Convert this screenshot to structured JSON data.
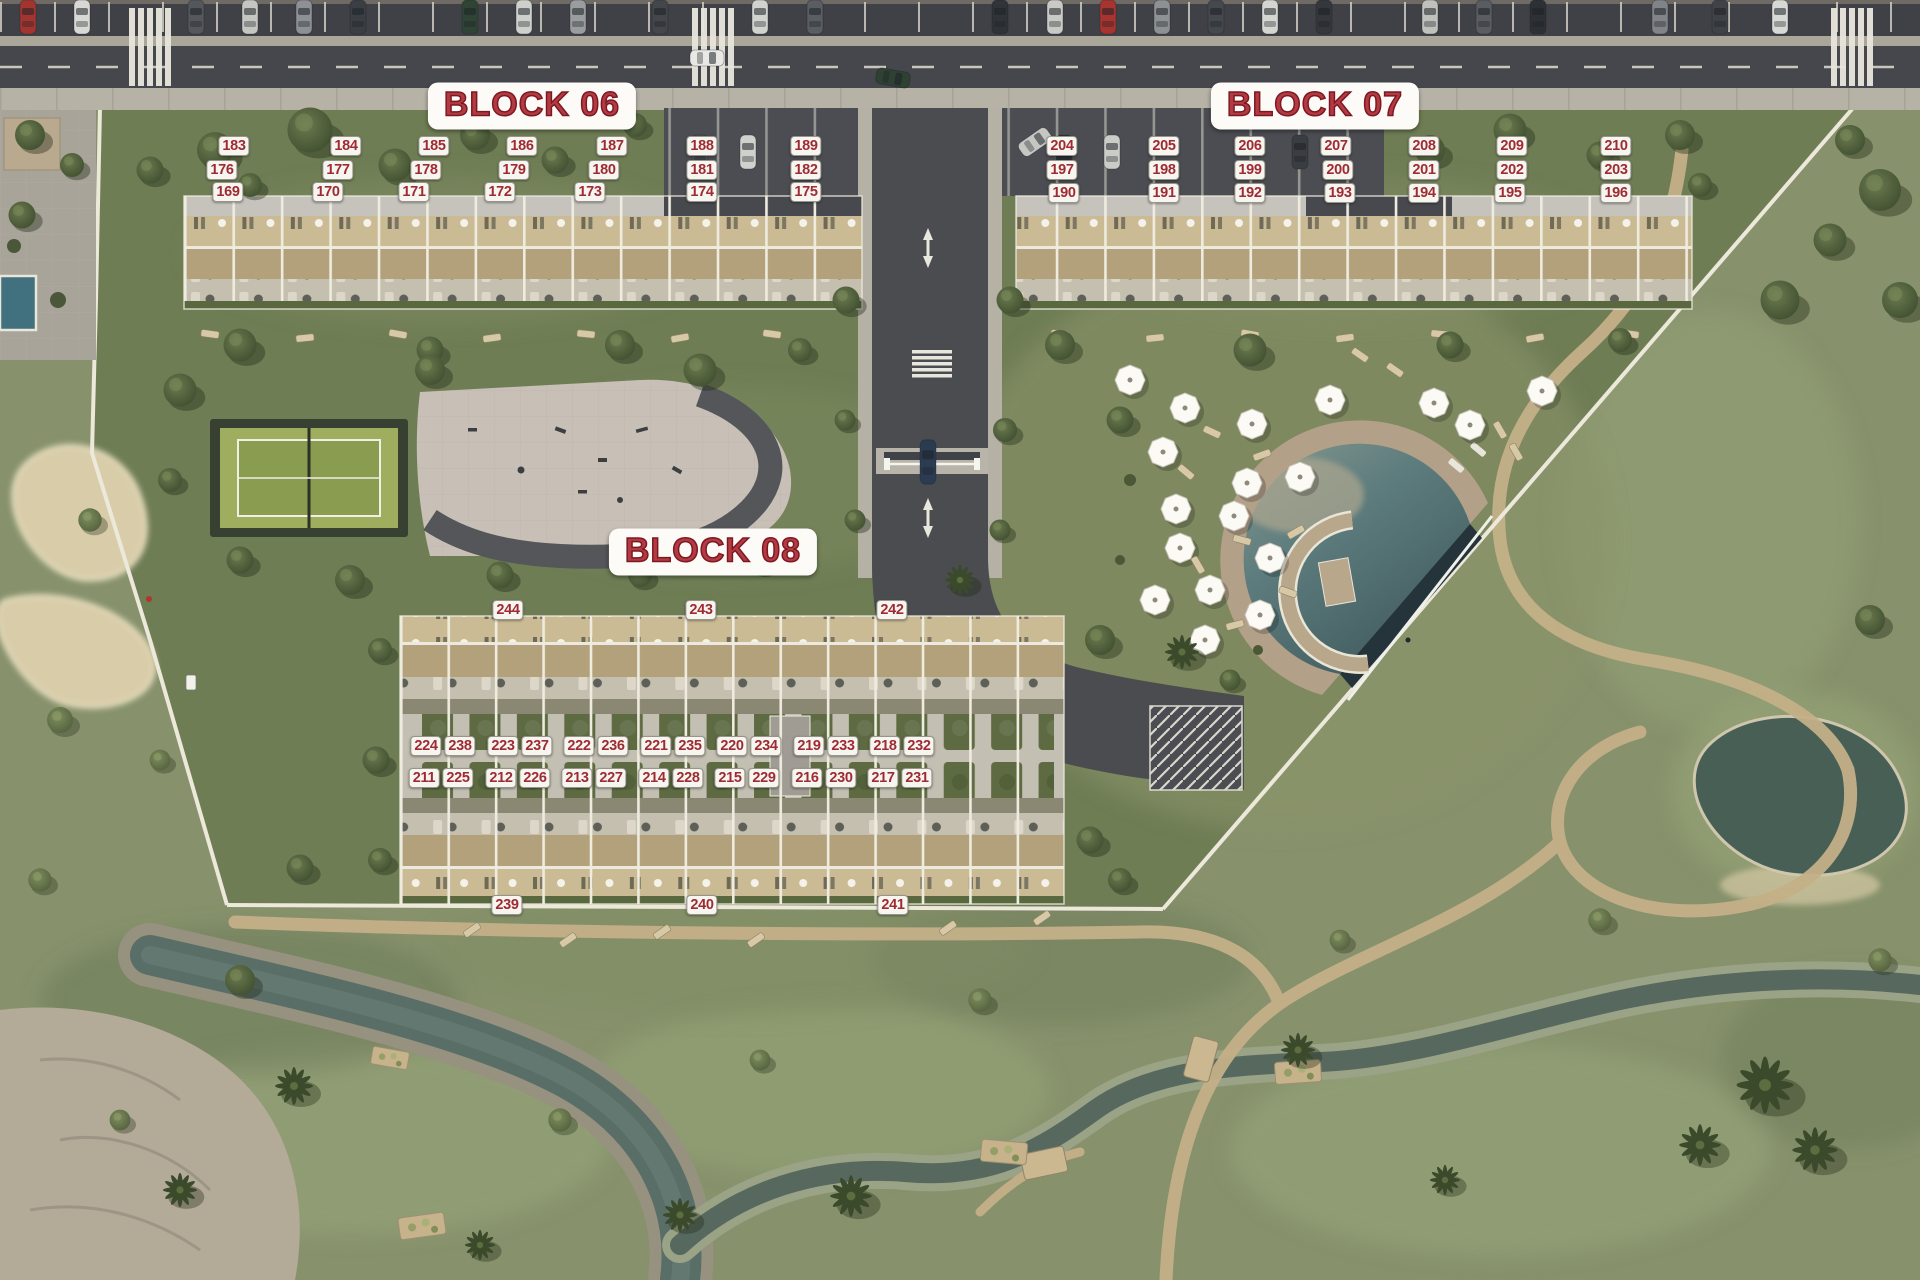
{
  "map": {
    "type": "residential-masterplan-aerial",
    "accent_red": "#9e2b33",
    "chip_bg": "#f7f5ef",
    "features": [
      "main-road",
      "entrance-road",
      "padel-court",
      "playground",
      "swimming-pool",
      "umbrella-lawn",
      "golf-course",
      "sand-bunkers",
      "pond",
      "stream"
    ]
  },
  "blocks": [
    {
      "id": "block-06",
      "title": "BLOCK 06",
      "units": [
        {
          "n": "183",
          "x": 234,
          "y": 146
        },
        {
          "n": "184",
          "x": 346,
          "y": 146
        },
        {
          "n": "185",
          "x": 434,
          "y": 146
        },
        {
          "n": "186",
          "x": 522,
          "y": 146
        },
        {
          "n": "187",
          "x": 612,
          "y": 146
        },
        {
          "n": "188",
          "x": 702,
          "y": 146
        },
        {
          "n": "189",
          "x": 806,
          "y": 146
        },
        {
          "n": "176",
          "x": 222,
          "y": 170
        },
        {
          "n": "177",
          "x": 338,
          "y": 170
        },
        {
          "n": "178",
          "x": 426,
          "y": 170
        },
        {
          "n": "179",
          "x": 514,
          "y": 170
        },
        {
          "n": "180",
          "x": 604,
          "y": 170
        },
        {
          "n": "181",
          "x": 702,
          "y": 170
        },
        {
          "n": "182",
          "x": 806,
          "y": 170
        },
        {
          "n": "169",
          "x": 228,
          "y": 192
        },
        {
          "n": "170",
          "x": 328,
          "y": 192
        },
        {
          "n": "171",
          "x": 414,
          "y": 192
        },
        {
          "n": "172",
          "x": 500,
          "y": 192
        },
        {
          "n": "173",
          "x": 590,
          "y": 192
        },
        {
          "n": "174",
          "x": 702,
          "y": 192
        },
        {
          "n": "175",
          "x": 806,
          "y": 192
        }
      ]
    },
    {
      "id": "block-07",
      "title": "BLOCK 07",
      "units": [
        {
          "n": "204",
          "x": 1062,
          "y": 146
        },
        {
          "n": "205",
          "x": 1164,
          "y": 146
        },
        {
          "n": "206",
          "x": 1250,
          "y": 146
        },
        {
          "n": "207",
          "x": 1336,
          "y": 146
        },
        {
          "n": "208",
          "x": 1424,
          "y": 146
        },
        {
          "n": "209",
          "x": 1512,
          "y": 146
        },
        {
          "n": "210",
          "x": 1616,
          "y": 146
        },
        {
          "n": "197",
          "x": 1062,
          "y": 170
        },
        {
          "n": "198",
          "x": 1164,
          "y": 170
        },
        {
          "n": "199",
          "x": 1250,
          "y": 170
        },
        {
          "n": "200",
          "x": 1338,
          "y": 170
        },
        {
          "n": "201",
          "x": 1424,
          "y": 170
        },
        {
          "n": "202",
          "x": 1512,
          "y": 170
        },
        {
          "n": "203",
          "x": 1616,
          "y": 170
        },
        {
          "n": "190",
          "x": 1064,
          "y": 193
        },
        {
          "n": "191",
          "x": 1164,
          "y": 193
        },
        {
          "n": "192",
          "x": 1250,
          "y": 193
        },
        {
          "n": "193",
          "x": 1340,
          "y": 193
        },
        {
          "n": "194",
          "x": 1424,
          "y": 193
        },
        {
          "n": "195",
          "x": 1510,
          "y": 193
        },
        {
          "n": "196",
          "x": 1616,
          "y": 193
        }
      ]
    },
    {
      "id": "block-08",
      "title": "BLOCK 08",
      "units": [
        {
          "n": "244",
          "x": 508,
          "y": 610
        },
        {
          "n": "243",
          "x": 701,
          "y": 610
        },
        {
          "n": "242",
          "x": 892,
          "y": 610
        },
        {
          "n": "224",
          "x": 426,
          "y": 746
        },
        {
          "n": "238",
          "x": 460,
          "y": 746
        },
        {
          "n": "223",
          "x": 503,
          "y": 746
        },
        {
          "n": "237",
          "x": 537,
          "y": 746
        },
        {
          "n": "222",
          "x": 579,
          "y": 746
        },
        {
          "n": "236",
          "x": 613,
          "y": 746
        },
        {
          "n": "221",
          "x": 656,
          "y": 746
        },
        {
          "n": "235",
          "x": 690,
          "y": 746
        },
        {
          "n": "220",
          "x": 732,
          "y": 746
        },
        {
          "n": "234",
          "x": 766,
          "y": 746
        },
        {
          "n": "219",
          "x": 809,
          "y": 746
        },
        {
          "n": "233",
          "x": 843,
          "y": 746
        },
        {
          "n": "218",
          "x": 885,
          "y": 746
        },
        {
          "n": "232",
          "x": 919,
          "y": 746
        },
        {
          "n": "211",
          "x": 424,
          "y": 778
        },
        {
          "n": "225",
          "x": 458,
          "y": 778
        },
        {
          "n": "212",
          "x": 501,
          "y": 778
        },
        {
          "n": "226",
          "x": 535,
          "y": 778
        },
        {
          "n": "213",
          "x": 577,
          "y": 778
        },
        {
          "n": "227",
          "x": 611,
          "y": 778
        },
        {
          "n": "214",
          "x": 654,
          "y": 778
        },
        {
          "n": "228",
          "x": 688,
          "y": 778
        },
        {
          "n": "215",
          "x": 730,
          "y": 778
        },
        {
          "n": "229",
          "x": 764,
          "y": 778
        },
        {
          "n": "216",
          "x": 807,
          "y": 778
        },
        {
          "n": "230",
          "x": 841,
          "y": 778
        },
        {
          "n": "217",
          "x": 883,
          "y": 778
        },
        {
          "n": "231",
          "x": 917,
          "y": 778
        },
        {
          "n": "239",
          "x": 507,
          "y": 905
        },
        {
          "n": "240",
          "x": 702,
          "y": 905
        },
        {
          "n": "241",
          "x": 893,
          "y": 905
        }
      ]
    }
  ]
}
